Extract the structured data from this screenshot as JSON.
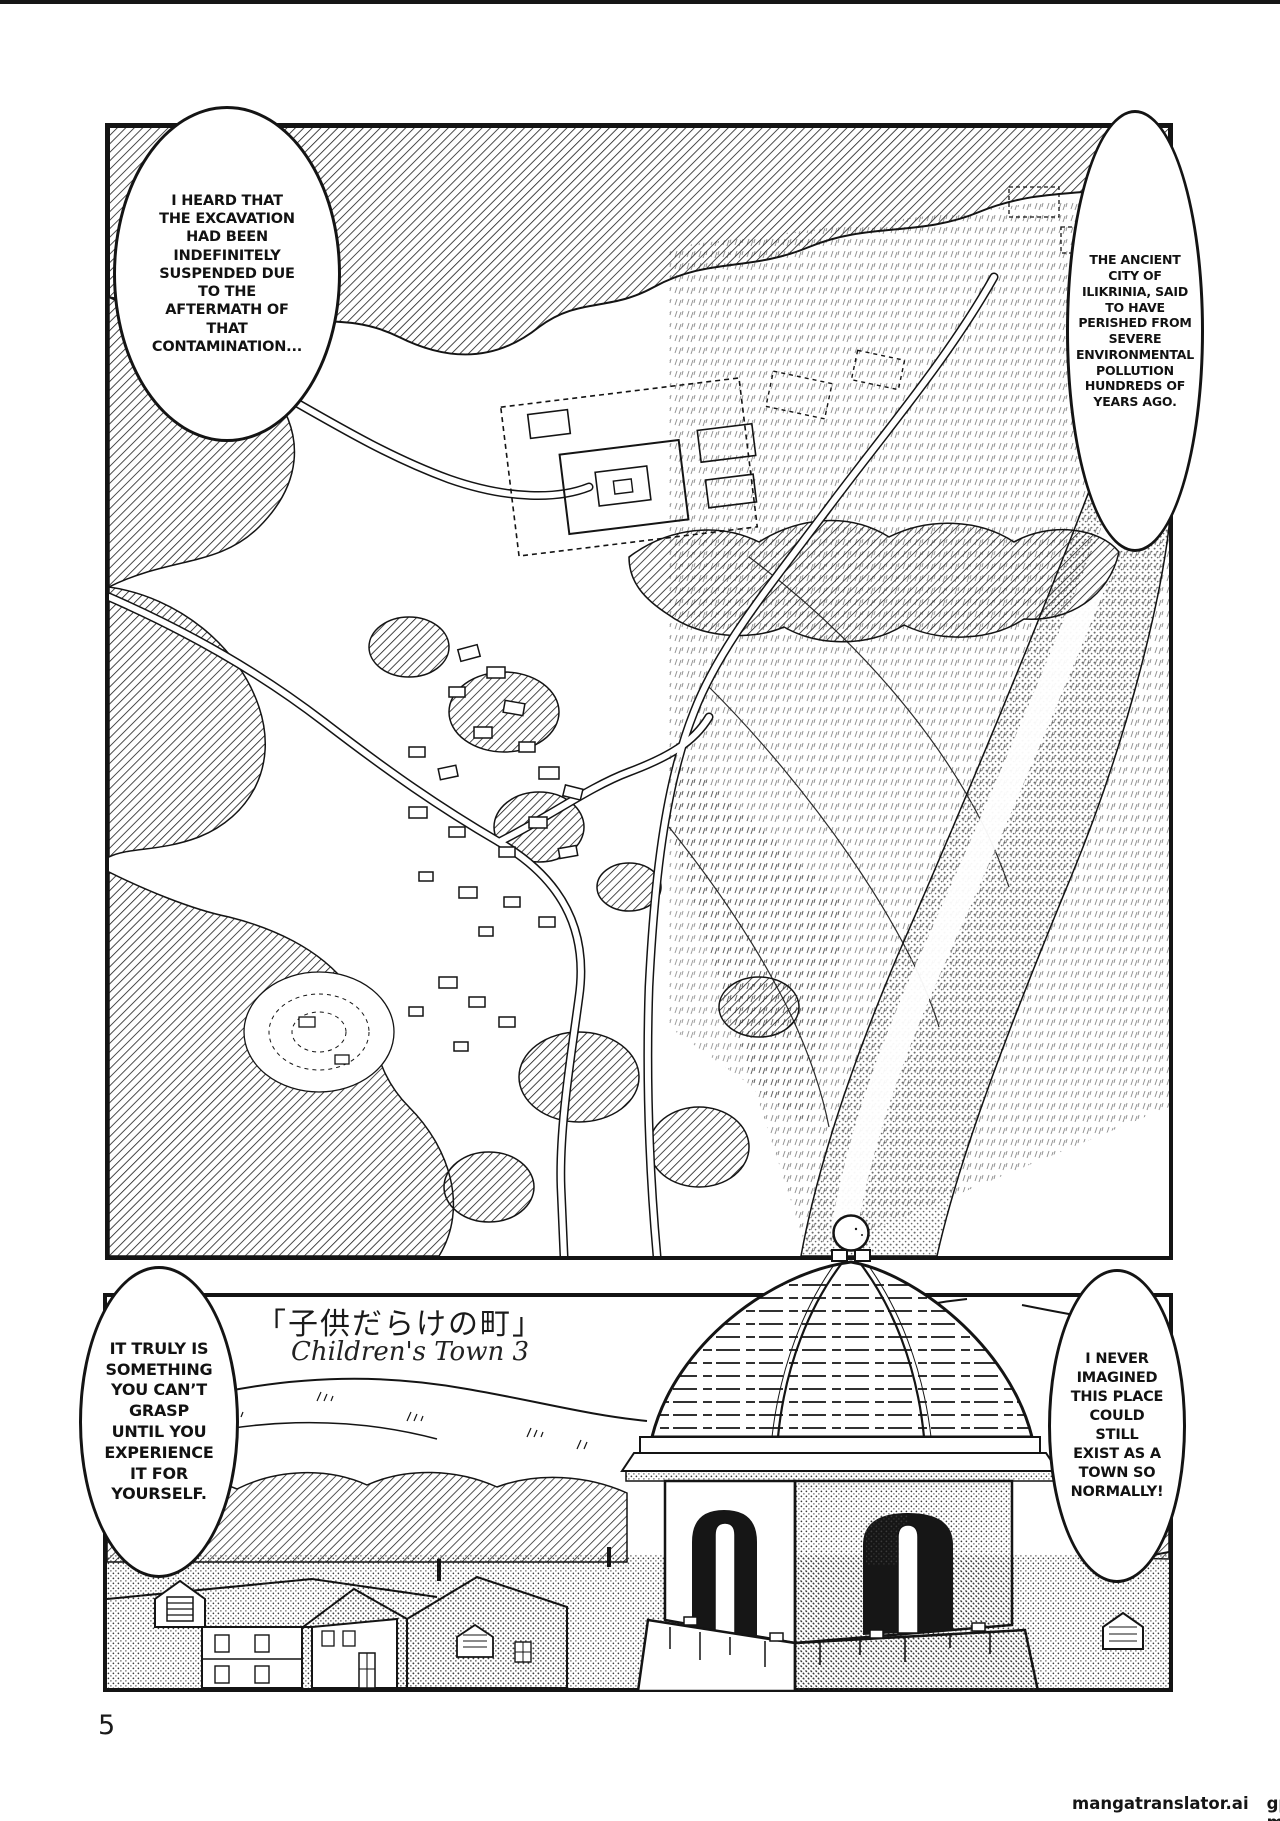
{
  "page": {
    "number": "5",
    "watermark": {
      "site": "mangatranslator.ai",
      "model": "gpt4o-mini"
    }
  },
  "title": {
    "japanese": "「子供だらけの町」",
    "english": "Children's Town 3"
  },
  "bubbles": {
    "top_left": "I HEARD THAT\nTHE EXCAVATION\nHAD BEEN\nINDEFINITELY\nSUSPENDED DUE\nTO THE\nAFTERMATH OF\nTHAT\nCONTAMINATION...",
    "top_right": "THE ANCIENT\nCITY OF\nILIKRINIA, SAID\nTO HAVE\nPERISHED FROM\nSEVERE\nENVIRONMENTAL\nPOLLUTION\nHUNDREDS OF\nYEARS AGO.",
    "bottom_left": "IT TRULY IS\nSOMETHING\nYOU CAN’T\nGRASP\nUNTIL YOU\nEXPERIENCE\nIT FOR\nYOURSELF.",
    "bottom_right": "I NEVER\nIMAGINED\nTHIS PLACE\nCOULD\nSTILL\nEXIST AS A\nTOWN SO\nNORMALLY!"
  },
  "colors": {
    "ink": "#141414",
    "paper": "#ffffff"
  }
}
